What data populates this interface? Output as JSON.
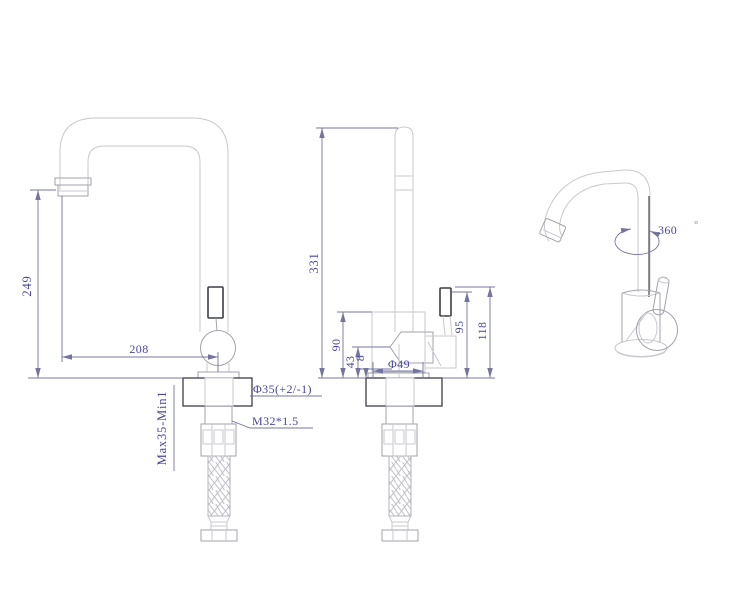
{
  "document": {
    "title": "kitchen faucet technical drawing, three orthographic/perspective views"
  },
  "colors": {
    "background": "#ffffff",
    "outline": "#c8c8d0",
    "outline-strong": "#a2a2ac",
    "edge-dark": "#3d3d46",
    "dim-line": "#7474a2",
    "dim-text": "#4646a6"
  },
  "views": {
    "front": {
      "label": "front view with mounting hardware",
      "dims": {
        "spout_height": "249",
        "spout_reach": "208",
        "hole_diameter": "Φ35(+2/-1)",
        "thread_spec": "M32*1.5",
        "mounting_thickness": "Max35-Min1"
      }
    },
    "side": {
      "label": "side view with mounting hardware",
      "dims": {
        "total_height": "331",
        "body_height": "90",
        "lower_body_height": "43",
        "base_lip_height": "8",
        "base_diameter": "Φ49",
        "outlet_height": "95",
        "handle_height": "118"
      }
    },
    "perspective": {
      "label": "perspective view",
      "swivel_value": "360",
      "swivel_unit": "°"
    }
  }
}
